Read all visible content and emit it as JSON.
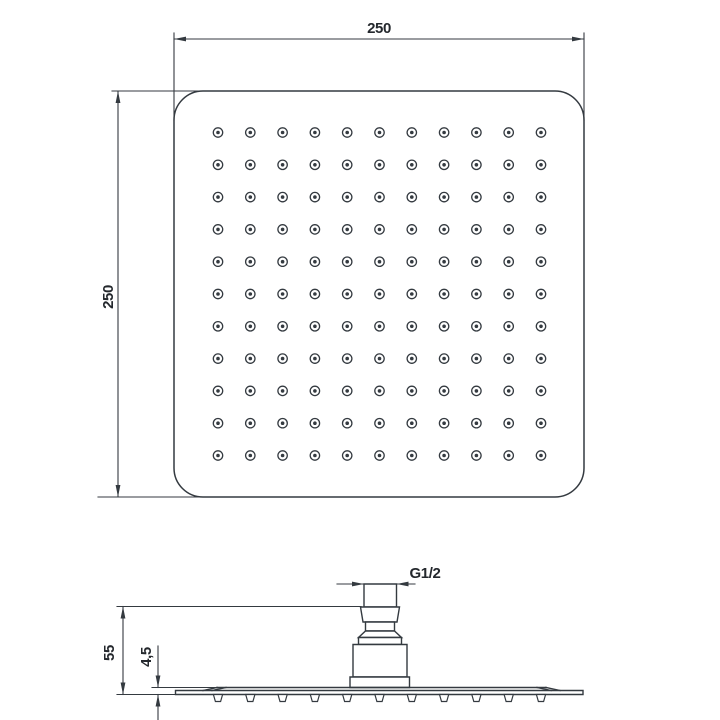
{
  "colors": {
    "line": "#343a40",
    "text": "#24282d",
    "bg": "#ffffff"
  },
  "top_view": {
    "width_dim": "250",
    "height_dim": "250",
    "nozzle_grid": {
      "rows": 11,
      "cols": 11
    }
  },
  "side_view": {
    "height_dim": "55",
    "thickness_dim": "4,5",
    "thread_dim": "G1/2",
    "nozzle_count": 11
  }
}
